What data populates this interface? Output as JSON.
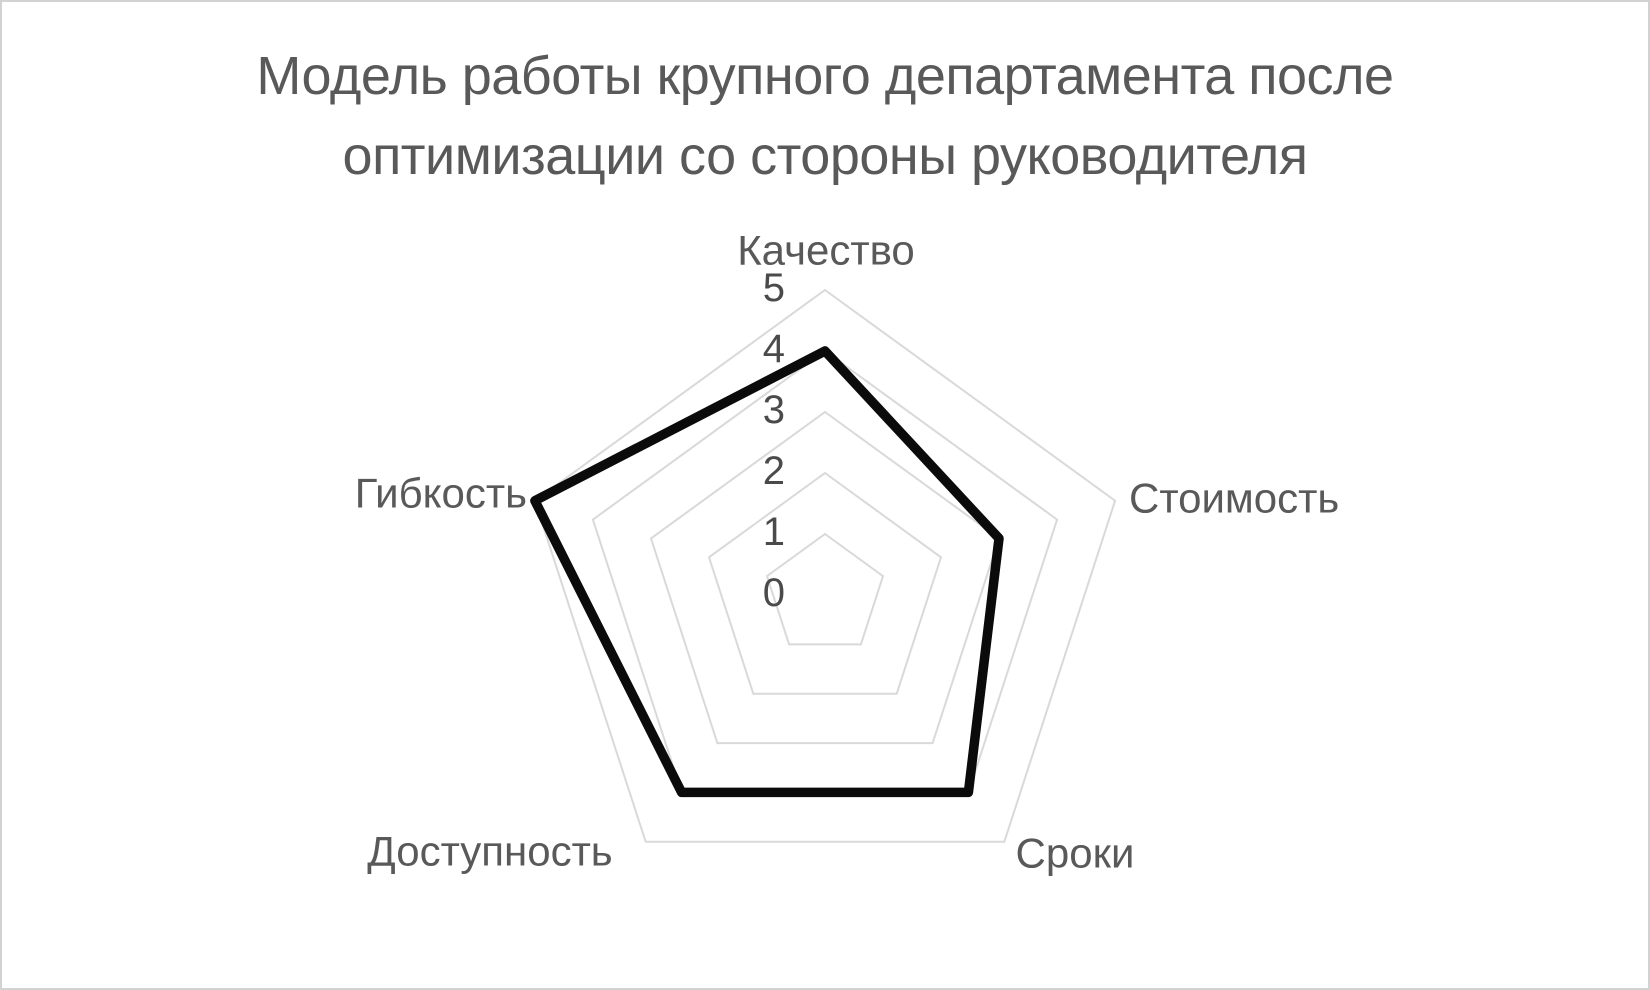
{
  "frame": {
    "background_color": "#ffffff",
    "border_color": "#d2d2d2"
  },
  "header": {
    "title_line1": "Модель работы крупного департамента после",
    "title_line2": "оптимизации со стороны руководителя",
    "title_color": "#595959"
  },
  "chart_data": {
    "type": "radar",
    "title": "Модель работы крупного департамента после оптимизации со стороны руководителя",
    "categories": [
      "Качество",
      "Стоимость",
      "Сроки",
      "Доступность",
      "Гибкость"
    ],
    "series": [
      {
        "values": [
          4,
          3,
          4,
          4,
          5
        ]
      }
    ],
    "axis": {
      "min": 0,
      "max": 5,
      "ticks": [
        0,
        1,
        2,
        3,
        4,
        5
      ]
    },
    "grid": true,
    "gridline_shape": "pentagon-rings",
    "radial_spokes": false,
    "legend": "none",
    "colors": {
      "series_line": "#0b0b0b",
      "gridline": "#d9d9d9",
      "category_label": "#595959",
      "tick_label": "#4a4a4a"
    }
  }
}
